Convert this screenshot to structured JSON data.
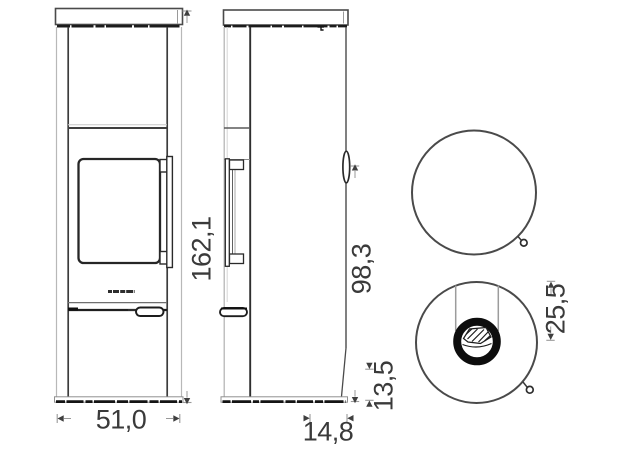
{
  "drawing": {
    "type": "stove-dimension-drawing",
    "colors": {
      "background": "#ffffff",
      "line_dark": "#1e1e1e",
      "line_mid": "#4a4a4a",
      "line_light": "#b8b8b8",
      "dimension_text": "#3a3a3a"
    },
    "dimensions": {
      "front_height": "162,1",
      "front_width": "51,0",
      "side_rear_outlet_height": "98,3",
      "side_base_height": "13,5",
      "side_outlet_depth": "14,8",
      "top_outlet_offset": "25,5"
    }
  }
}
